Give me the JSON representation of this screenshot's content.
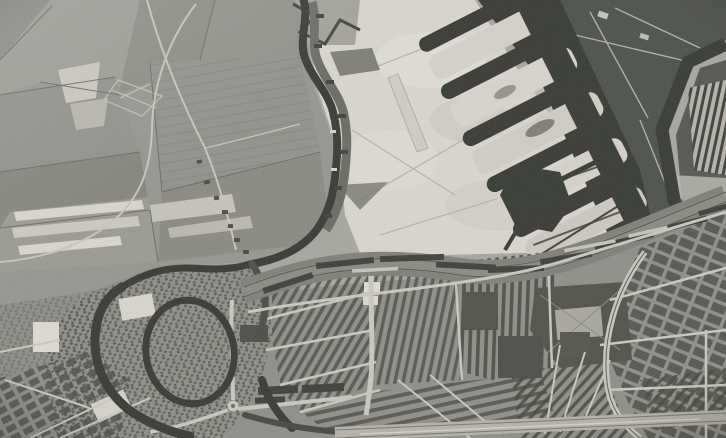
{
  "image": {
    "kind": "black-and-white vertical aerial photograph",
    "subject": "Dutch town seen from above: polder fields and a winding river on the left, bright sand flats and harbour piers with dark water docks at top right, a diagonal railway yard across the middle, and a dense old town with moats, canals, row-housing districts, parks and a light highway band across the bottom"
  },
  "palette": {
    "paper": "#a7a7a0",
    "field_base": "#95968f",
    "field_dark": "#7d7f77",
    "field_mid": "#8a8c84",
    "field_light": "#b2b1a9",
    "strip_bright": "#d8d6cd",
    "water": "#383b36",
    "sand": "#d8d6cd",
    "land_dark": "#4e514b",
    "dock_dark": "#555851",
    "urban_base": "#8e8f88",
    "block_dark": "#4a4c45",
    "road_light": "#c9c7bf",
    "rail_band": "#7f8079",
    "park_dark": "#4f524a",
    "bright_roof": "#dcdad2",
    "highway": "#b4b2aa",
    "wharf": "#6a6c64"
  },
  "regions": {
    "fields": "polder fields",
    "river": "winding river",
    "sand": "sand flats under reclamation",
    "harbour": "harbour basin with piers",
    "railway": "railway corridor and yards",
    "old_town": "moated old town core",
    "districts": "row-housing districts",
    "parks": "tree parks",
    "highway": "light highway band"
  }
}
